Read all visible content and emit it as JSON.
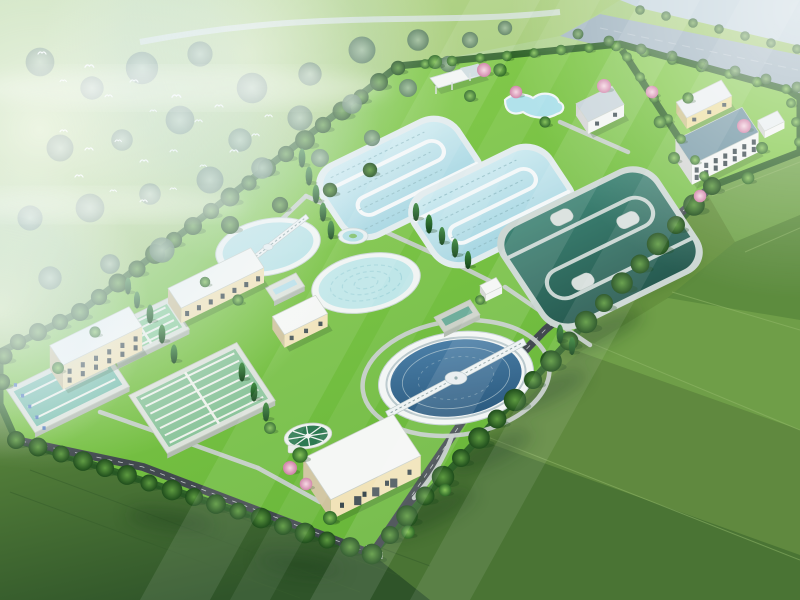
{
  "scene": {
    "description": "Aerial bird's-eye 3D architectural rendering of a wastewater treatment plant campus on bright green lawns, surrounded by misty forest with a flock of white birds, a grey river-road band at top right, farm-field patchwork at bottom right, and diagonal sun rays from the upper right",
    "style": "isometric architectural visualization",
    "no_visible_text": true,
    "lighting": "sun rays streaking from upper right, haze over upper left forest"
  },
  "palette": {
    "mist": "#dcebf3",
    "skyHaze": "#c3d4dd",
    "forestMeadow": "#aed083",
    "lawn": "#82cb41",
    "lawnDark": "#63b336",
    "adminLawn": "#86ca4f",
    "hedge": "#2c5f28",
    "asphalt": "#42494f",
    "pathGray": "#c6cdcb",
    "riverRoad": "#a3b6c2",
    "fieldBase": "#66923f",
    "fieldDark": "#3f6c33",
    "ditchWater": "#b8dfe9",
    "ditchRim": "#e2ecee",
    "darkBasinWater": "#2f6b5e",
    "clarifierWater": "#b9e2e6",
    "bigClarifierWater": "#35668c",
    "thickenerWater": "#2e7a52",
    "filterWater": "#79bfae",
    "laneWater": "#8cc59c",
    "greenWater": "#8fcf9e",
    "pondWater": "#6fae9c",
    "cream": "#f1e3b8",
    "yellowWall": "#ecdc9b",
    "white": "#f3f5f3",
    "roofWhite": "#f5f7f5",
    "roofBlueGray": "#c6d2d9",
    "roofTeal": "#6f94a2",
    "roofPale": "#e9eef0",
    "windowDark": "#3c4b50",
    "rimConc": "#dde3dc",
    "stone": "#cdd2c9",
    "equipBlue": "#4f79bd",
    "pinkTree": "#e0a4c4",
    "birdWhite": "#ffffff"
  },
  "site": {
    "facilities": [
      "oxidation-ditch-1",
      "oxidation-ditch-2",
      "anoxic-serpentine-basin",
      "clarifier-with-bridge",
      "clarifier-rippled",
      "large-clarifier-with-truss-bridge",
      "sludge-thickener",
      "fountain-pool",
      "decorative-pool",
      "pavilion",
      "filter-basin",
      "sedimentation-basin",
      "aeration-basin",
      "contact-tank",
      "outfall-pond",
      "lab-building",
      "blower-building",
      "dosing-building",
      "dewatering-garage",
      "gate-house",
      "admin-house",
      "office-building",
      "annex-building",
      "pump-station",
      "entrance-gate"
    ],
    "surroundings": [
      "misty forest with bird flock",
      "river road band",
      "farm field patchwork",
      "perimeter tree hedge"
    ]
  },
  "buildings": [
    {
      "id": "lab-building",
      "cx": 96,
      "cy": 360,
      "w": 88,
      "d": 24,
      "h": 24,
      "wall": "cream",
      "roof": "roofWhite",
      "rows": 2,
      "cols": 6,
      "doors": 0
    },
    {
      "id": "blower-building",
      "cx": 216,
      "cy": 293,
      "w": 92,
      "d": 24,
      "h": 15,
      "wall": "cream",
      "roof": "roofWhite",
      "rows": 1,
      "cols": 7,
      "doors": 0
    },
    {
      "id": "dosing-building",
      "cx": 300,
      "cy": 328,
      "w": 48,
      "d": 22,
      "h": 13,
      "wall": "cream",
      "roof": "roofWhite",
      "rows": 1,
      "cols": 3,
      "doors": 0
    },
    {
      "id": "dewatering-garage",
      "cx": 362,
      "cy": 477,
      "w": 100,
      "d": 50,
      "h": 20,
      "wall": "cream",
      "roof": "roofWhite",
      "rows": 1,
      "cols": 4,
      "doors": 3
    },
    {
      "id": "gate-house",
      "cx": 600,
      "cy": 116,
      "w": 40,
      "d": 22,
      "h": 12,
      "wall": "white",
      "roof": "roofBlueGray",
      "rows": 1,
      "cols": 2,
      "doors": 0
    },
    {
      "id": "admin-house",
      "cx": 704,
      "cy": 110,
      "w": 50,
      "d": 19,
      "h": 11,
      "wall": "yellowWall",
      "roof": "roofPale",
      "rows": 1,
      "cols": 3,
      "doors": 0
    },
    {
      "id": "office-building",
      "cx": 717,
      "cy": 156,
      "w": 74,
      "d": 30,
      "h": 20,
      "wall": "white",
      "roof": "roofTeal",
      "rows": 2,
      "cols": 7,
      "doors": 0
    },
    {
      "id": "annex-building",
      "cx": 771,
      "cy": 128,
      "w": 22,
      "d": 13,
      "h": 7,
      "wall": "white",
      "roof": "roofPale",
      "rows": 0,
      "cols": 0,
      "doors": 0
    },
    {
      "id": "pump-station",
      "cx": 491,
      "cy": 293,
      "w": 18,
      "d": 11,
      "h": 7,
      "wall": "white",
      "roof": "roofWhite",
      "rows": 0,
      "cols": 0,
      "doors": 0
    }
  ],
  "basins": [
    {
      "id": "filter-basin",
      "cx": 68,
      "cy": 388,
      "w": 105,
      "d": 52,
      "rim": "rimConc",
      "water": "filterWater",
      "lanes": 4,
      "dots": 5
    },
    {
      "id": "sedimentation-basin",
      "cx": 202,
      "cy": 398,
      "w": 120,
      "d": 70,
      "rim": "rimConc",
      "water": "laneWater",
      "lanes": 8,
      "dots": 0
    },
    {
      "id": "aeration-basin",
      "cx": 143,
      "cy": 331,
      "w": 80,
      "d": 38,
      "rim": "rimConc",
      "water": "greenWater",
      "lanes": 5,
      "dots": 0
    },
    {
      "id": "contact-tank",
      "cx": 285,
      "cy": 287,
      "w": 34,
      "d": 16,
      "rim": "rimConc",
      "water": "ditchWater",
      "lanes": 0,
      "dots": 0
    },
    {
      "id": "outfall-pond",
      "cx": 457,
      "cy": 316,
      "w": 40,
      "d": 18,
      "rim": "stone",
      "water": "pondWater",
      "lanes": 0,
      "dots": 0
    }
  ],
  "vegetation": {
    "f": [
      [
        398,
        68,
        0.8
      ],
      [
        379,
        82,
        1
      ],
      [
        361,
        97,
        0.85
      ],
      [
        342,
        111,
        1.05
      ],
      [
        323,
        125,
        0.9
      ],
      [
        305,
        140,
        1.1
      ],
      [
        286,
        154,
        0.9
      ],
      [
        267,
        168,
        1
      ],
      [
        249,
        183,
        0.85
      ],
      [
        230,
        197,
        1.05
      ],
      [
        211,
        211,
        0.9
      ],
      [
        193,
        226,
        1
      ],
      [
        174,
        240,
        0.9
      ],
      [
        155,
        254,
        1.1
      ],
      [
        137,
        269,
        0.95
      ],
      [
        118,
        283,
        1.05
      ],
      [
        99,
        297,
        0.9
      ],
      [
        80,
        312,
        1
      ],
      [
        712,
        186,
        1
      ],
      [
        694,
        205,
        1.2
      ],
      [
        676,
        225,
        1
      ],
      [
        658,
        244,
        1.25
      ],
      [
        640,
        264,
        1.05
      ],
      [
        622,
        283,
        1.2
      ],
      [
        604,
        303,
        1
      ],
      [
        586,
        322,
        1.25
      ],
      [
        569,
        341,
        1.05
      ],
      [
        551,
        361,
        1.2
      ],
      [
        533,
        380,
        1
      ],
      [
        515,
        400,
        1.25
      ],
      [
        497,
        419,
        1.05
      ],
      [
        479,
        438,
        1.2
      ],
      [
        461,
        458,
        1
      ],
      [
        443,
        477,
        1.25
      ],
      [
        425,
        496,
        1.05
      ],
      [
        407,
        516,
        1.2
      ],
      [
        390,
        535,
        1
      ],
      [
        372,
        554,
        1.15
      ],
      [
        350,
        547,
        1.1
      ],
      [
        327,
        540,
        0.95
      ],
      [
        305,
        533,
        1.15
      ],
      [
        283,
        526,
        1
      ],
      [
        261,
        518,
        1.15
      ],
      [
        238,
        511,
        0.95
      ],
      [
        216,
        504,
        1.1
      ],
      [
        194,
        497,
        1
      ],
      [
        172,
        490,
        1.15
      ],
      [
        149,
        483,
        0.95
      ],
      [
        127,
        475,
        1.1
      ],
      [
        105,
        468,
        1
      ],
      [
        83,
        461,
        1.1
      ],
      [
        61,
        454,
        0.95
      ],
      [
        38,
        447,
        1.05
      ],
      [
        16,
        440,
        1
      ],
      [
        60,
        322,
        0.9
      ],
      [
        38,
        332,
        1
      ],
      [
        18,
        342,
        0.9
      ],
      [
        4,
        356,
        0.95
      ],
      [
        2,
        382,
        0.9
      ],
      [
        230,
        225,
        1
      ],
      [
        280,
        205,
        0.9
      ],
      [
        330,
        190,
        0.8
      ],
      [
        370,
        170,
        0.8
      ]
    ],
    "f2": [
      [
        40,
        62,
        1.6
      ],
      [
        92,
        88,
        1.3
      ],
      [
        142,
        68,
        1.8
      ],
      [
        200,
        54,
        1.4
      ],
      [
        252,
        88,
        1.7
      ],
      [
        310,
        74,
        1.3
      ],
      [
        362,
        50,
        1.5
      ],
      [
        418,
        40,
        1.2
      ],
      [
        60,
        148,
        1.5
      ],
      [
        122,
        140,
        1.2
      ],
      [
        180,
        120,
        1.6
      ],
      [
        240,
        140,
        1.3
      ],
      [
        300,
        118,
        1.4
      ],
      [
        352,
        104,
        1.1
      ],
      [
        30,
        218,
        1.4
      ],
      [
        90,
        208,
        1.6
      ],
      [
        150,
        194,
        1.2
      ],
      [
        210,
        180,
        1.5
      ],
      [
        262,
        168,
        1.2
      ],
      [
        320,
        158,
        1
      ],
      [
        50,
        278,
        1.3
      ],
      [
        110,
        264,
        1.1
      ],
      [
        162,
        250,
        1.4
      ],
      [
        408,
        88,
        1
      ],
      [
        448,
        64,
        0.9
      ],
      [
        372,
        138,
        0.9
      ],
      [
        470,
        40,
        0.9
      ],
      [
        505,
        28,
        0.8
      ]
    ],
    "g": [
      [
        425,
        64,
        0.7
      ],
      [
        452,
        61,
        0.75
      ],
      [
        480,
        58,
        0.7
      ],
      [
        507,
        56,
        0.75
      ],
      [
        534,
        53,
        0.7
      ],
      [
        561,
        50,
        0.75
      ],
      [
        589,
        48,
        0.7
      ],
      [
        616,
        46,
        0.75
      ],
      [
        644,
        52,
        0.75
      ],
      [
        672,
        60,
        0.7
      ],
      [
        701,
        67,
        0.75
      ],
      [
        729,
        74,
        0.7
      ],
      [
        757,
        82,
        0.75
      ],
      [
        786,
        89,
        0.7
      ],
      [
        791,
        103,
        0.7
      ],
      [
        796,
        122,
        0.7
      ],
      [
        799,
        142,
        0.7
      ],
      [
        627,
        57,
        0.7
      ],
      [
        640,
        77,
        0.7
      ],
      [
        654,
        98,
        0.7
      ],
      [
        668,
        119,
        0.7
      ],
      [
        681,
        139,
        0.7
      ],
      [
        695,
        160,
        0.7
      ],
      [
        704,
        176,
        0.7
      ],
      [
        435,
        62,
        1
      ],
      [
        500,
        70,
        0.95
      ],
      [
        470,
        96,
        0.85
      ],
      [
        545,
        122,
        0.8
      ],
      [
        300,
        455,
        1.1
      ],
      [
        330,
        518,
        1
      ],
      [
        408,
        532,
        0.95
      ],
      [
        445,
        490,
        0.9
      ],
      [
        270,
        428,
        0.85
      ],
      [
        660,
        122,
        0.9
      ],
      [
        674,
        158,
        0.85
      ],
      [
        748,
        178,
        0.9
      ],
      [
        762,
        148,
        0.85
      ],
      [
        688,
        98,
        0.8
      ],
      [
        95,
        332,
        0.8
      ],
      [
        58,
        368,
        0.85
      ],
      [
        238,
        300,
        0.8
      ],
      [
        205,
        282,
        0.75
      ],
      [
        480,
        300,
        0.7
      ]
    ],
    "c": [
      [
        302,
        158,
        1
      ],
      [
        309,
        176,
        1
      ],
      [
        316,
        194,
        1
      ],
      [
        323,
        212,
        1
      ],
      [
        331,
        230,
        1
      ],
      [
        416,
        212,
        0.95
      ],
      [
        429,
        224,
        1
      ],
      [
        442,
        236,
        0.95
      ],
      [
        455,
        248,
        1
      ],
      [
        468,
        260,
        0.95
      ],
      [
        560,
        334,
        1
      ],
      [
        572,
        346,
        0.95
      ],
      [
        150,
        314,
        1
      ],
      [
        162,
        334,
        1
      ],
      [
        174,
        354,
        1
      ],
      [
        242,
        372,
        1
      ],
      [
        254,
        392,
        1
      ],
      [
        266,
        412,
        1
      ],
      [
        137,
        300,
        0.9
      ],
      [
        128,
        286,
        0.9
      ]
    ],
    "riv": [
      [
        640,
        10,
        0.8
      ],
      [
        666,
        16,
        0.8
      ],
      [
        693,
        23,
        0.8
      ],
      [
        719,
        29,
        0.8
      ],
      [
        745,
        36,
        0.8
      ],
      [
        771,
        43,
        0.8
      ],
      [
        797,
        49,
        0.8
      ],
      [
        578,
        34,
        0.9
      ],
      [
        609,
        41,
        0.9
      ],
      [
        641,
        49,
        0.9
      ],
      [
        672,
        56,
        0.9
      ],
      [
        703,
        64,
        0.9
      ],
      [
        735,
        71,
        0.9
      ],
      [
        766,
        79,
        0.9
      ],
      [
        797,
        87,
        0.9
      ]
    ],
    "p": [
      [
        484,
        70,
        1
      ],
      [
        516,
        92,
        0.9
      ],
      [
        604,
        86,
        1
      ],
      [
        652,
        92,
        0.9
      ],
      [
        744,
        126,
        1
      ],
      [
        700,
        196,
        0.9
      ],
      [
        290,
        468,
        1
      ],
      [
        306,
        484,
        0.9
      ]
    ]
  },
  "birds": [
    [
      38,
      52,
      1
    ],
    [
      60,
      80,
      0.8
    ],
    [
      85,
      65,
      1.1
    ],
    [
      105,
      95,
      0.9
    ],
    [
      130,
      80,
      1
    ],
    [
      150,
      110,
      0.8
    ],
    [
      172,
      95,
      1.1
    ],
    [
      195,
      120,
      0.9
    ],
    [
      215,
      105,
      1
    ],
    [
      60,
      130,
      0.9
    ],
    [
      85,
      148,
      1
    ],
    [
      115,
      140,
      0.8
    ],
    [
      140,
      160,
      1
    ],
    [
      170,
      150,
      0.9
    ],
    [
      200,
      165,
      0.8
    ],
    [
      230,
      150,
      1
    ],
    [
      252,
      134,
      0.9
    ],
    [
      110,
      190,
      0.8
    ],
    [
      140,
      200,
      0.9
    ],
    [
      170,
      188,
      0.8
    ],
    [
      75,
      175,
      1
    ],
    [
      265,
      115,
      0.9
    ]
  ]
}
